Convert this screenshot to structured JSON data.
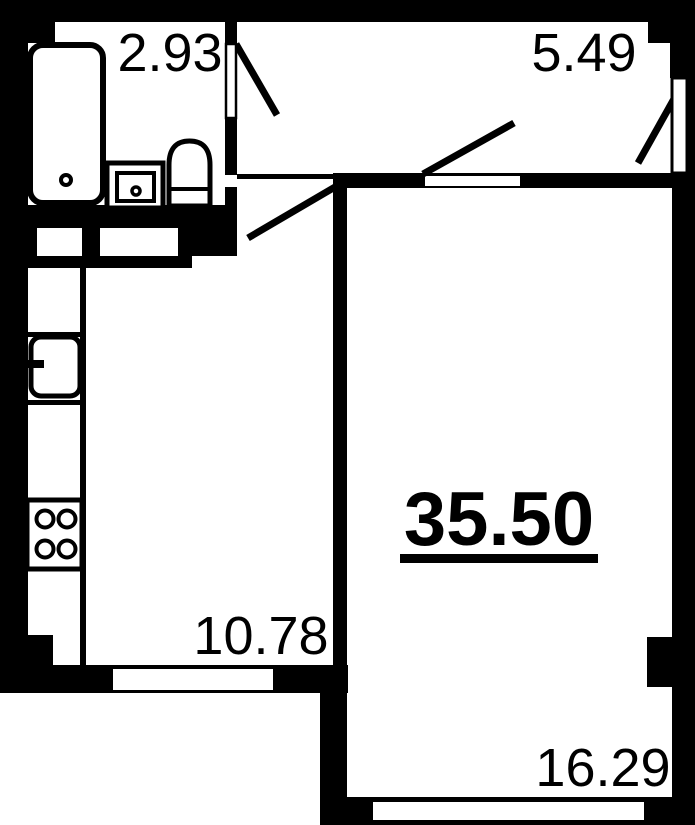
{
  "plan": {
    "total_area": "35.50",
    "rooms": {
      "bathroom": "2.93",
      "hallway": "5.49",
      "kitchen_living": "10.78",
      "living_room": "16.29"
    },
    "colors": {
      "wall": "#000000",
      "floor": "#ffffff"
    }
  }
}
